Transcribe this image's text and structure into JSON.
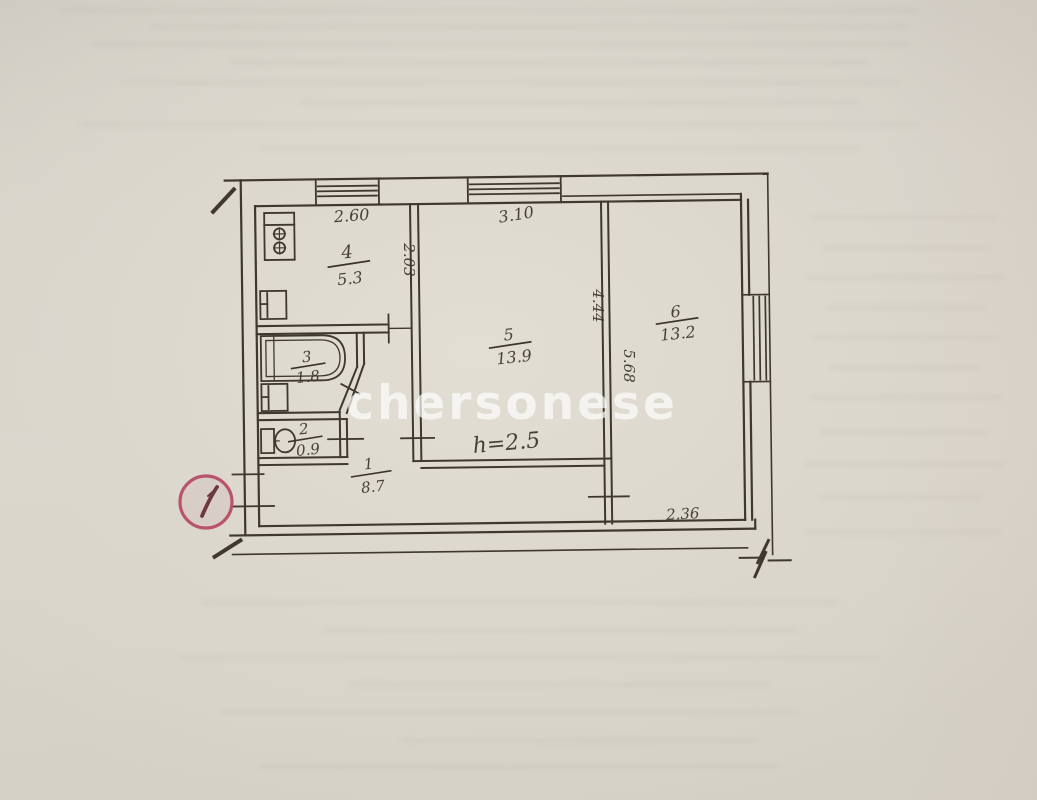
{
  "watermark": {
    "text": "chersonese"
  },
  "entry_marker": {
    "label": "1"
  },
  "rooms": {
    "r4": {
      "number": "4",
      "area": "5.3"
    },
    "r5": {
      "number": "5",
      "area": "13.9"
    },
    "r6": {
      "number": "6",
      "area": "13.2"
    },
    "r3": {
      "number": "3",
      "area": "1.8"
    },
    "r2": {
      "number": "2",
      "area": "0.9"
    },
    "r1": {
      "number": "1",
      "area": "8.7"
    }
  },
  "dimensions": {
    "kitchen_window": "2.60",
    "room5_window": "3.10",
    "kitchen_side": "2.03",
    "room5_side": "4.44",
    "room6_side": "5.68",
    "room6_bottom": "2.36",
    "height_note": "h=2.5"
  },
  "colors": {
    "paper": "#d9d5cc",
    "ink": "#3e382e",
    "marker_red": "#b8536b",
    "watermark": "#ffffff"
  }
}
